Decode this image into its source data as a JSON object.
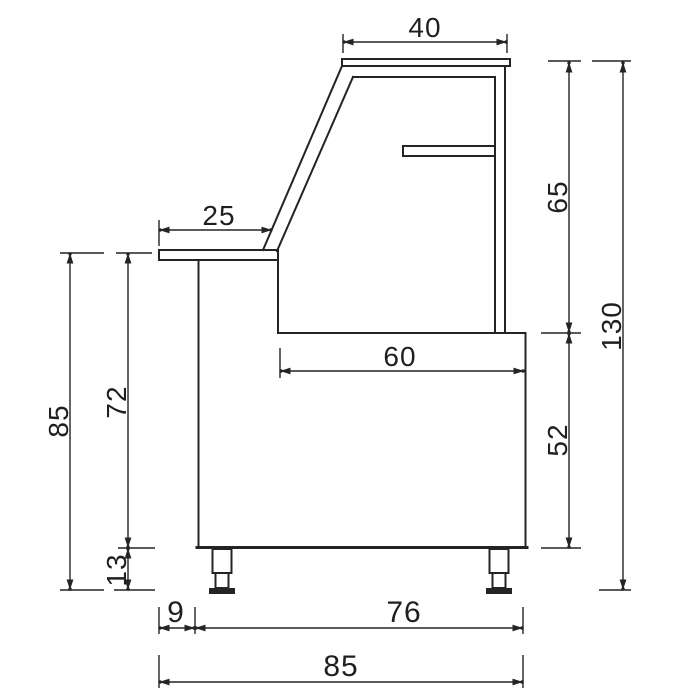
{
  "drawing": {
    "type": "technical-side-elevation",
    "subject": "refrigerated-display-counter",
    "line_color": "#242424",
    "background_color": "#ffffff",
    "units_shown": false,
    "dimensions": {
      "top_width": "40",
      "counter_depth": "25",
      "display_height": "65",
      "overall_height": "130",
      "worktop_width": "60",
      "base_height": "52",
      "left_height": "85",
      "counter_height": "72",
      "leg_height": "13",
      "counter_overhang": "9",
      "cabinet_depth": "76",
      "overall_depth": "85"
    }
  }
}
